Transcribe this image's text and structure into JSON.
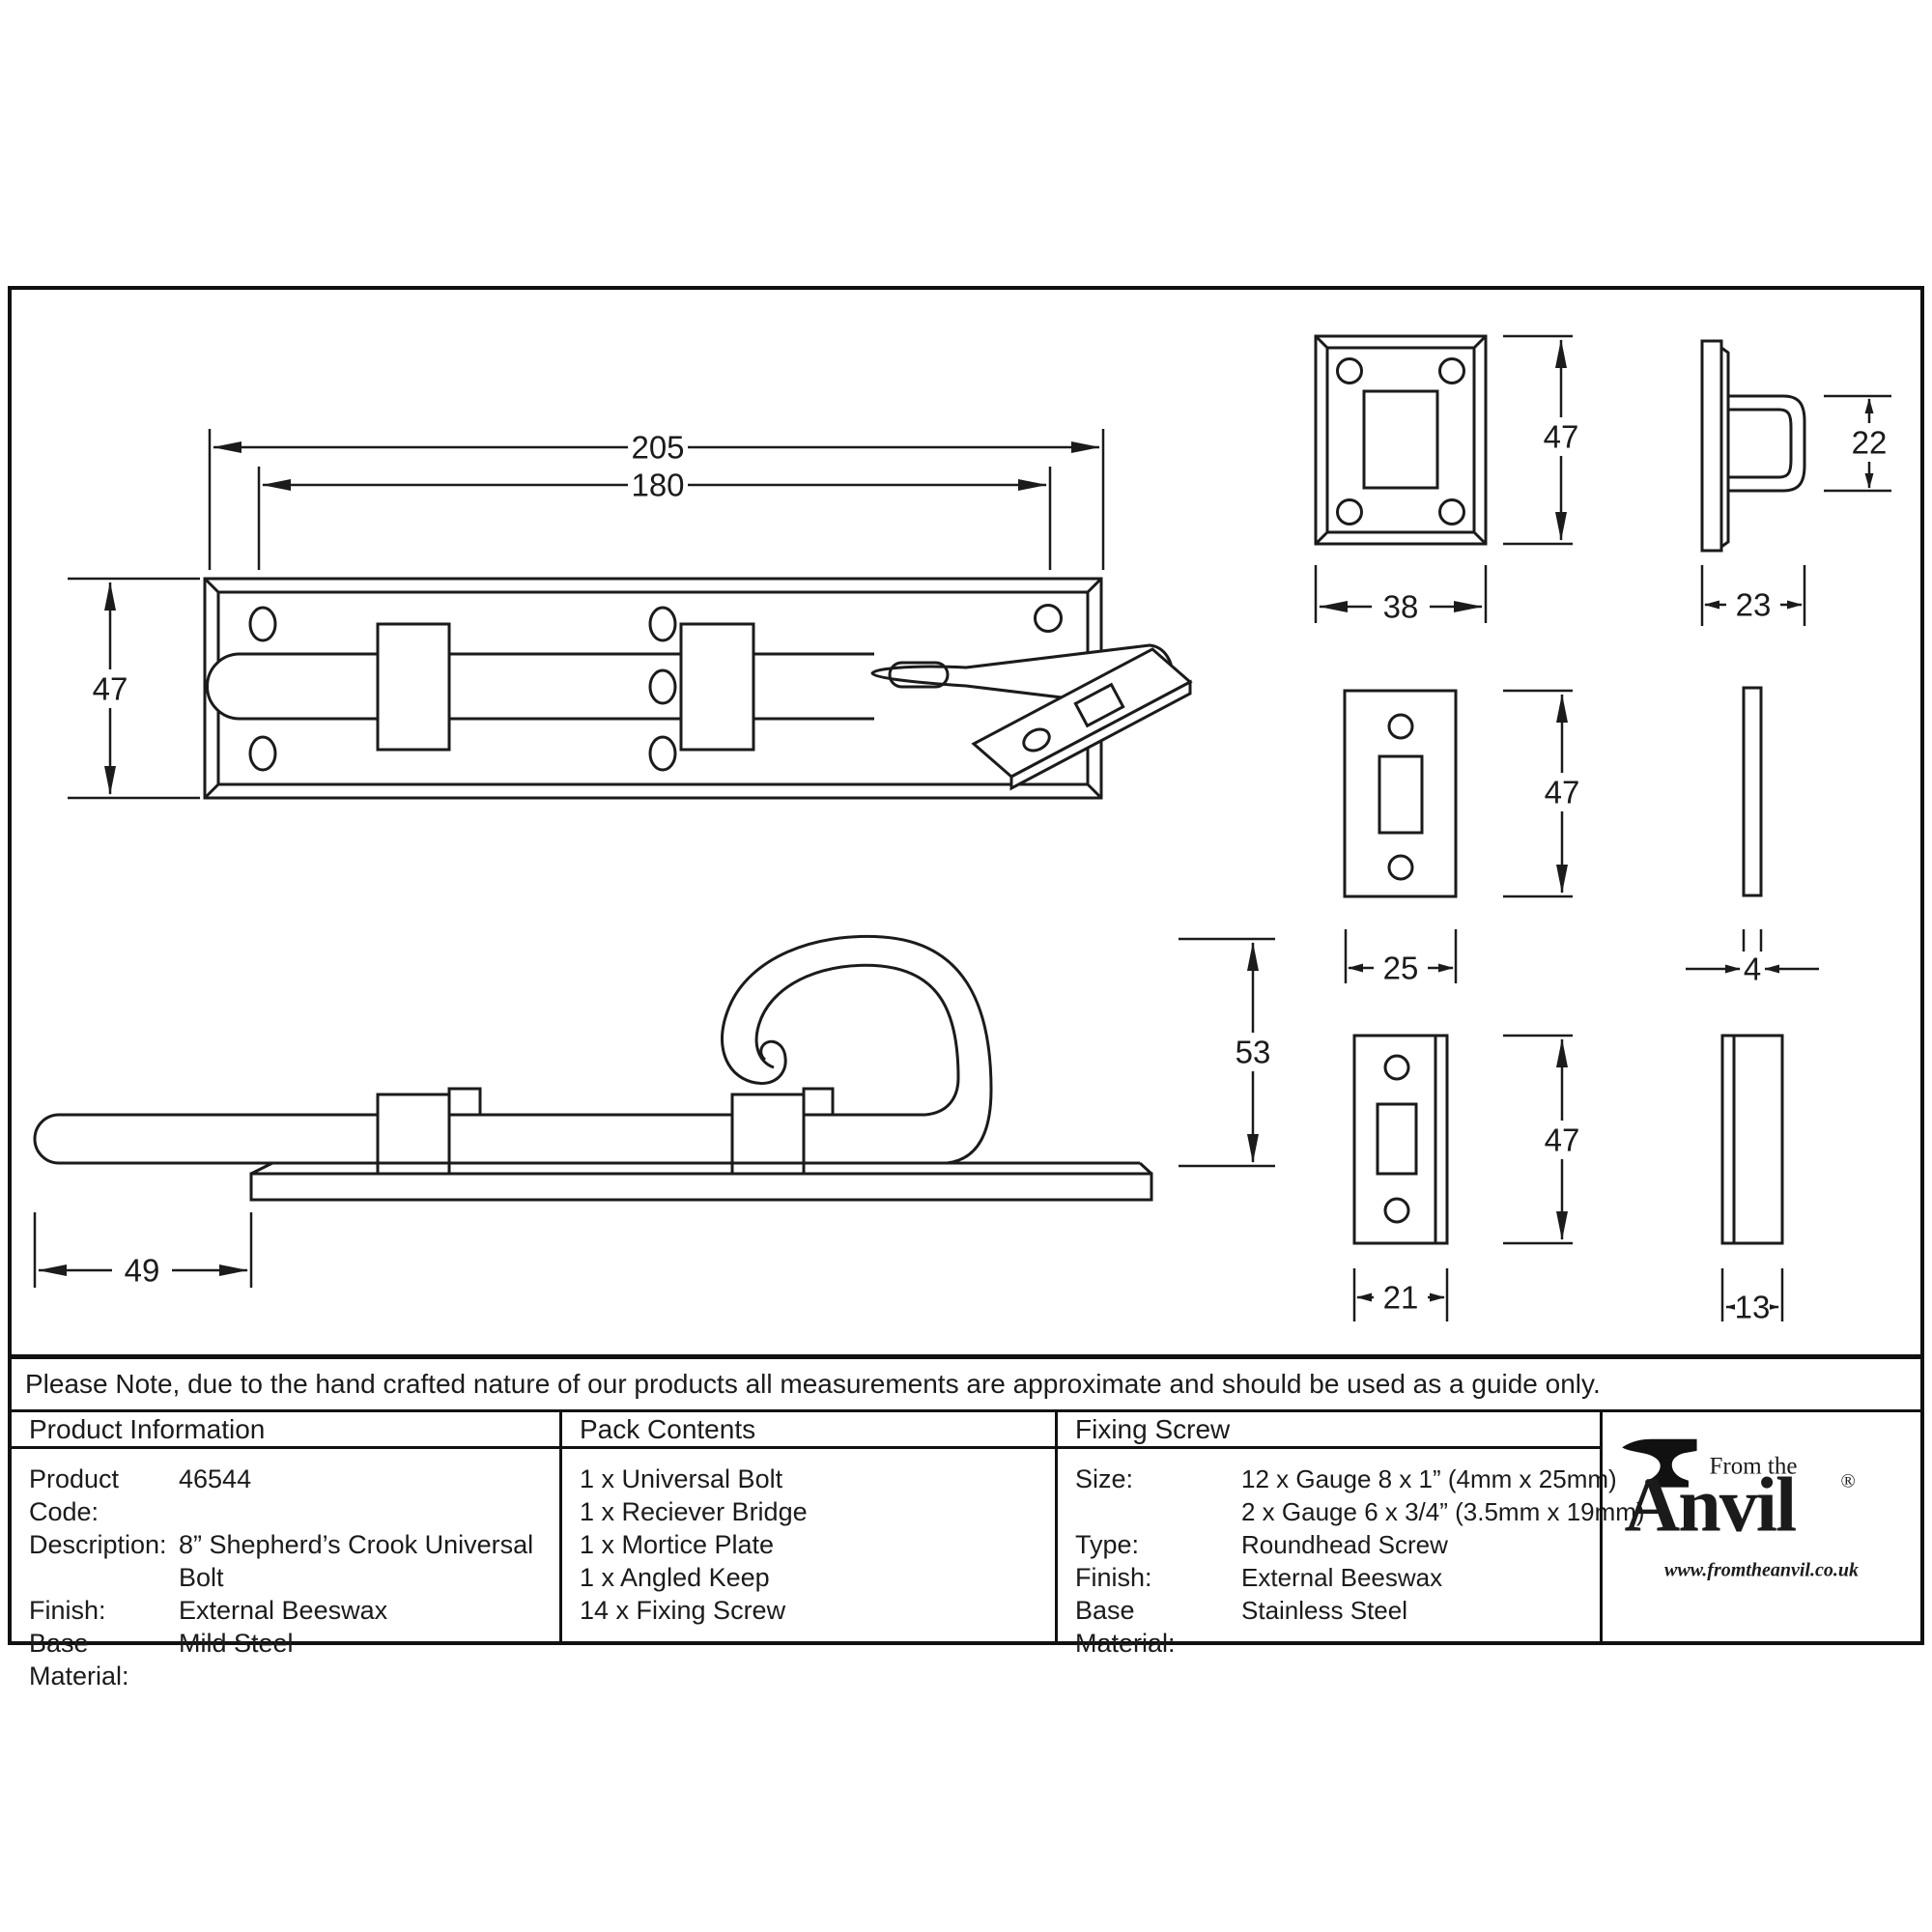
{
  "note": "Please Note, due to the hand crafted nature of our products all measurements are approximate and should be used as a guide only.",
  "dims": {
    "plan_overall": "205",
    "plan_inner": "180",
    "plan_height": "47",
    "side_tail": "49",
    "crook_height": "53",
    "bridge_height": "47",
    "bridge_width": "38",
    "bridge_loop_height": "22",
    "bridge_depth": "23",
    "mortice_height": "47",
    "mortice_width": "25",
    "mortice_thickness": "4",
    "keep_height": "47",
    "keep_width": "21",
    "keep_thickness": "13"
  },
  "table": {
    "product_information": {
      "header": "Product Information",
      "rows": [
        {
          "label": "Product Code:",
          "value": "46544"
        },
        {
          "label": "Description:",
          "value": "8” Shepherd’s Crook Universal Bolt"
        },
        {
          "label": "Finish:",
          "value": "External Beeswax"
        },
        {
          "label": "Base Material:",
          "value": "Mild Steel"
        }
      ]
    },
    "pack_contents": {
      "header": "Pack Contents",
      "items": [
        "1 x Universal Bolt",
        "1 x Reciever Bridge",
        "1 x Mortice Plate",
        "1 x Angled Keep",
        "14 x Fixing Screw"
      ]
    },
    "fixing_screw": {
      "header": "Fixing Screw",
      "rows": [
        {
          "label": "Size:",
          "value": "12 x Gauge 8 x 1” (4mm x 25mm)"
        },
        {
          "label": "",
          "value": "2 x Gauge 6 x 3/4” (3.5mm x 19mm)"
        },
        {
          "label": "Type:",
          "value": "Roundhead Screw"
        },
        {
          "label": "Finish:",
          "value": "External Beeswax"
        },
        {
          "label": "Base Material:",
          "value": "Stainless Steel"
        }
      ]
    }
  },
  "logo": {
    "tagline": "From the",
    "name": "Anvil",
    "registered": "®",
    "url": "www.fromtheanvil.co.uk"
  }
}
